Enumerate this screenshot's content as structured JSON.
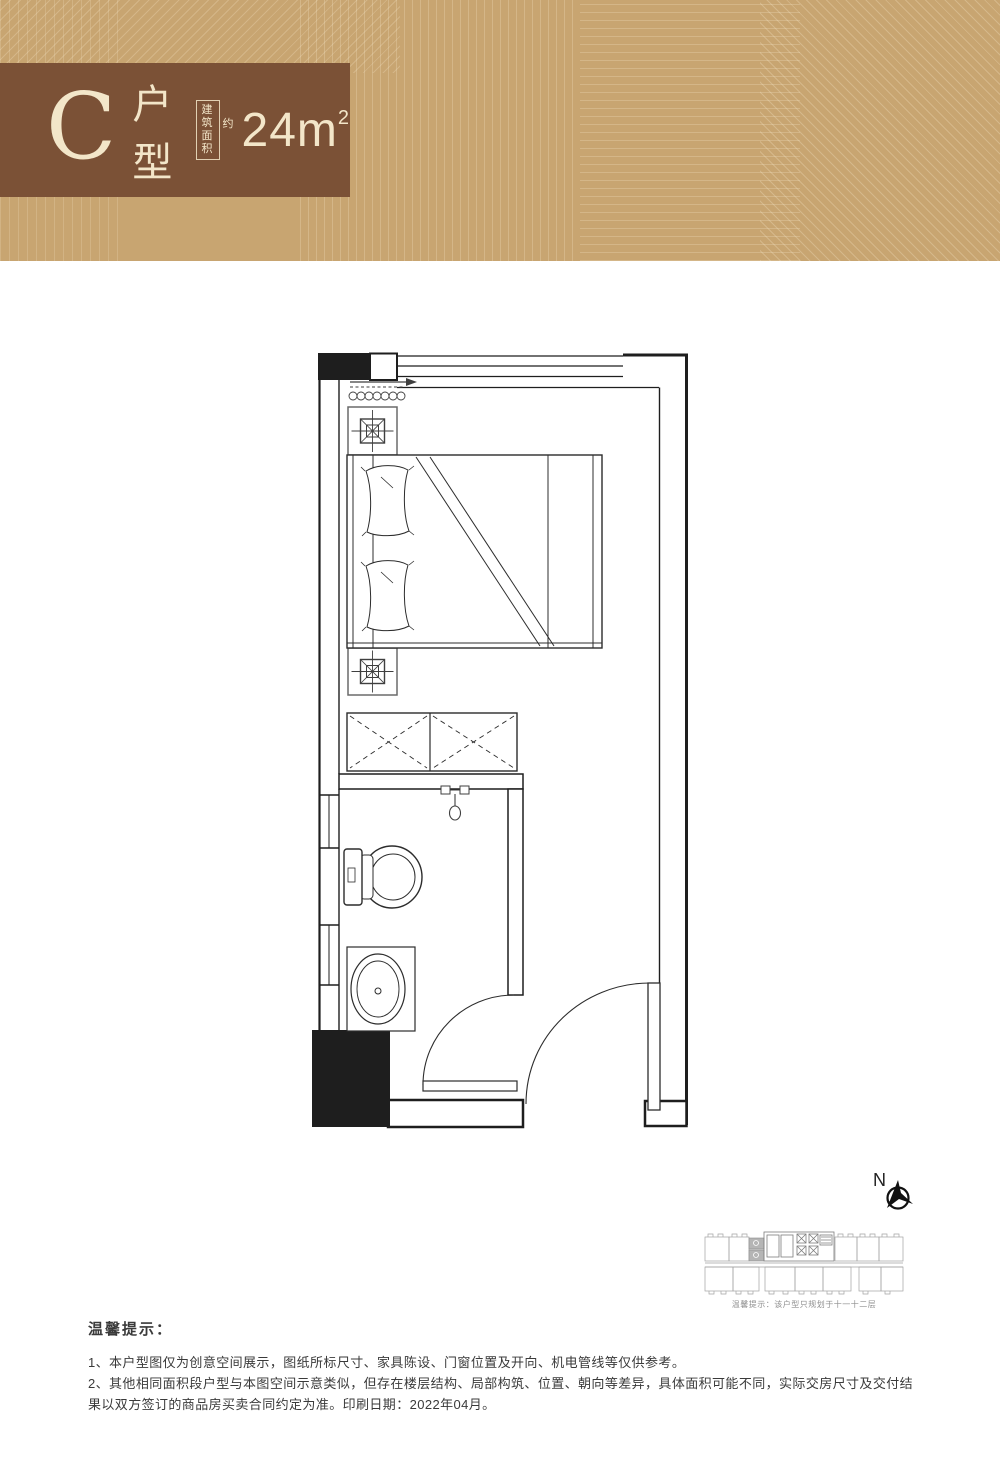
{
  "header": {
    "unit_letter": "C",
    "unit_label": "户型",
    "area_box_line1": "建筑",
    "area_box_line2": "面积",
    "area_approx": "约",
    "area_value": "24m",
    "area_sup": "2",
    "colors": {
      "band_bg": "#c8a571",
      "plate_bg": "#7b5136",
      "text": "#f3e6c9"
    }
  },
  "plan": {
    "compass_label": "N",
    "wall_color": "#1e1e1e",
    "furniture_color": "#4a4a4a"
  },
  "keyplan": {
    "caption": "温馨提示：该户型只规划于十一十二层",
    "highlight_color": "#b5b5b5"
  },
  "footer": {
    "heading": "温馨提示：",
    "note1": "1、本户型图仅为创意空间展示，图纸所标尺寸、家具陈设、门窗位置及开向、机电管线等仅供参考。",
    "note2": "2、其他相同面积段户型与本图空间示意类似，但存在楼层结构、局部构筑、位置、朝向等差异，具体面积可能不同，实际交房尺寸及交付结果以双方签订的商品房买卖合同约定为准。印刷日期：2022年04月。"
  }
}
